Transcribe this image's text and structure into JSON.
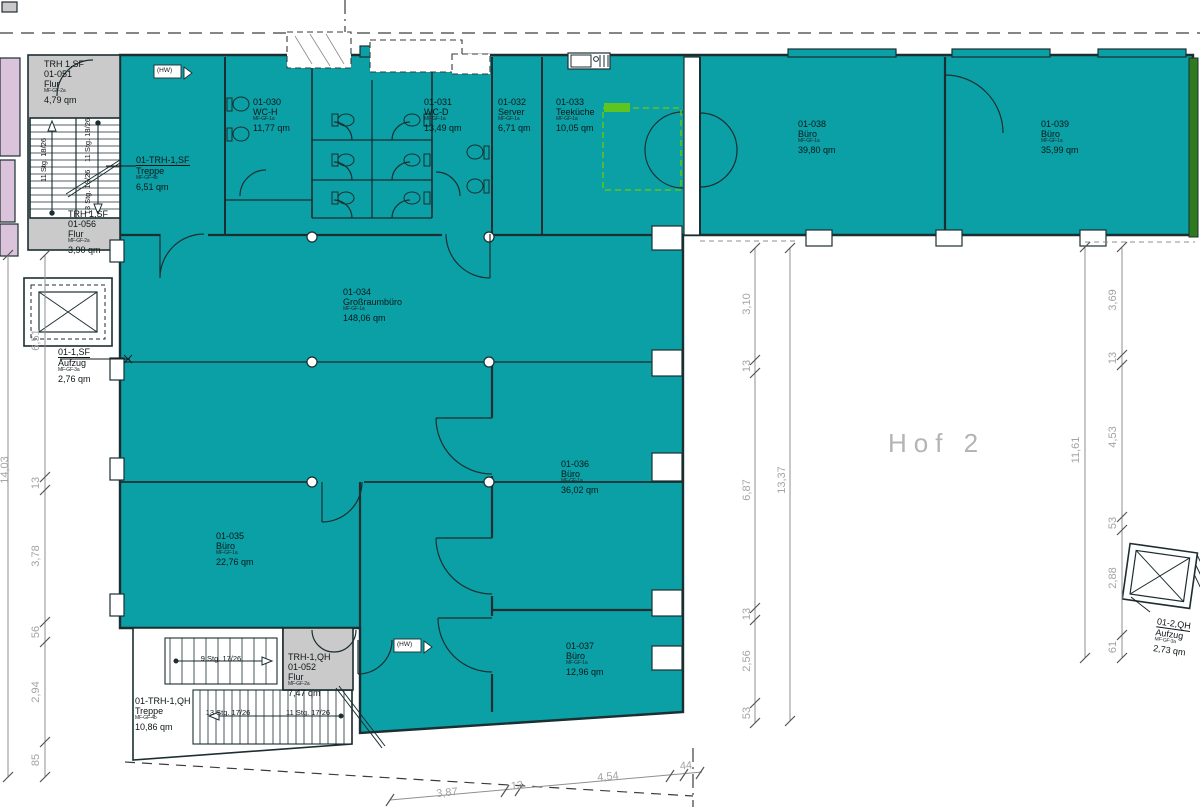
{
  "courtyard": {
    "label": "Hof 2"
  },
  "rooms": [
    {
      "building": "TRH 1,SF",
      "id": "01-051",
      "name": "Flur",
      "code": "MF-GF-2a",
      "area": "4,79 qm"
    },
    {
      "id": "01-TRH-1,SF",
      "name": "Treppe",
      "code": "MF-GF-4b",
      "area": "6,51 qm"
    },
    {
      "building": "TRH 1,SF",
      "id": "01-056",
      "name": "Flur",
      "code": "MF-GF-2a",
      "area": "3,90 qm"
    },
    {
      "id": "01-1,SF",
      "name": "Aufzug",
      "code": "MF-GF-3a",
      "area": "2,76 qm"
    },
    {
      "id": "01-030",
      "name": "WC-H",
      "code": "MF-GF-1a",
      "area": "11,77 qm"
    },
    {
      "id": "01-031",
      "name": "WC-D",
      "code": "MF-GF-1a",
      "area": "13,49 qm"
    },
    {
      "id": "01-032",
      "name": "Server",
      "code": "MF-GF-1a",
      "area": "6,71 qm"
    },
    {
      "id": "01-033",
      "name": "Teeküche",
      "code": "MF-GF-1a",
      "area": "10,05 qm"
    },
    {
      "id": "01-038",
      "name": "Büro",
      "code": "MF-GF-1a",
      "area": "39,80 qm"
    },
    {
      "id": "01-039",
      "name": "Büro",
      "code": "MF-GF-1a",
      "area": "35,99 qm"
    },
    {
      "id": "01-034",
      "name": "Großraumbüro",
      "code": "MF-GF-1a",
      "area": "148,06 qm"
    },
    {
      "id": "01-036",
      "name": "Büro",
      "code": "MF-GF-1a",
      "area": "36,02 qm"
    },
    {
      "id": "01-035",
      "name": "Büro",
      "code": "MF-GF-1a",
      "area": "22,76 qm"
    },
    {
      "id": "01-037",
      "name": "Büro",
      "code": "MF-GF-1a",
      "area": "12,96 qm"
    },
    {
      "building": "TRH-1,QH",
      "id": "01-052",
      "name": "Flur",
      "code": "MF-GF-2a",
      "area": "7,47 qm"
    },
    {
      "id": "01-TRH-1,QH",
      "name": "Treppe",
      "code": "MF-GF-4b",
      "area": "10,86 qm"
    },
    {
      "id": "01-2,QH",
      "name": "Aufzug",
      "code": "MF-GF-3a",
      "area": "2,73 qm"
    }
  ],
  "stairs": {
    "sf_left": {
      "steps": "11 Stg.",
      "ratio": "18/26"
    },
    "sf_right_upper": {
      "steps": "11 Stg.",
      "ratio": "18/26"
    },
    "sf_right_lower": {
      "steps": "13 Stg.",
      "ratio": "18/26"
    },
    "qh_upper": {
      "steps": "9 Stg.",
      "ratio": "17/26"
    },
    "qh_mid": {
      "steps": "13 Stg.",
      "ratio": "17/26"
    },
    "qh_lower": {
      "steps": "11 Stg.",
      "ratio": "17/26"
    }
  },
  "dims": {
    "left_total": "14,03",
    "left": [
      "6,51",
      "13",
      "3,78",
      "56",
      "2,94",
      "85"
    ],
    "middle": [
      "3,10",
      "13",
      "6,87",
      "13",
      "2,56",
      "53"
    ],
    "middle_total": "13,37",
    "right": [
      "3,69",
      "13",
      "4,53",
      "53",
      "2,88",
      "61"
    ],
    "right_total": "11,61",
    "bottom": [
      "3,87",
      "13",
      "4,54",
      "44"
    ]
  },
  "markers": {
    "hw": "(HW)"
  },
  "colors": {
    "room_fill": "#0aa0a5",
    "corridor_fill": "#cbcaca",
    "neighbor_fill": "#dcc3dc",
    "annotation_green": "#5fc41f",
    "edge_green": "#2f7a1f",
    "ink": "#1b2e31"
  }
}
